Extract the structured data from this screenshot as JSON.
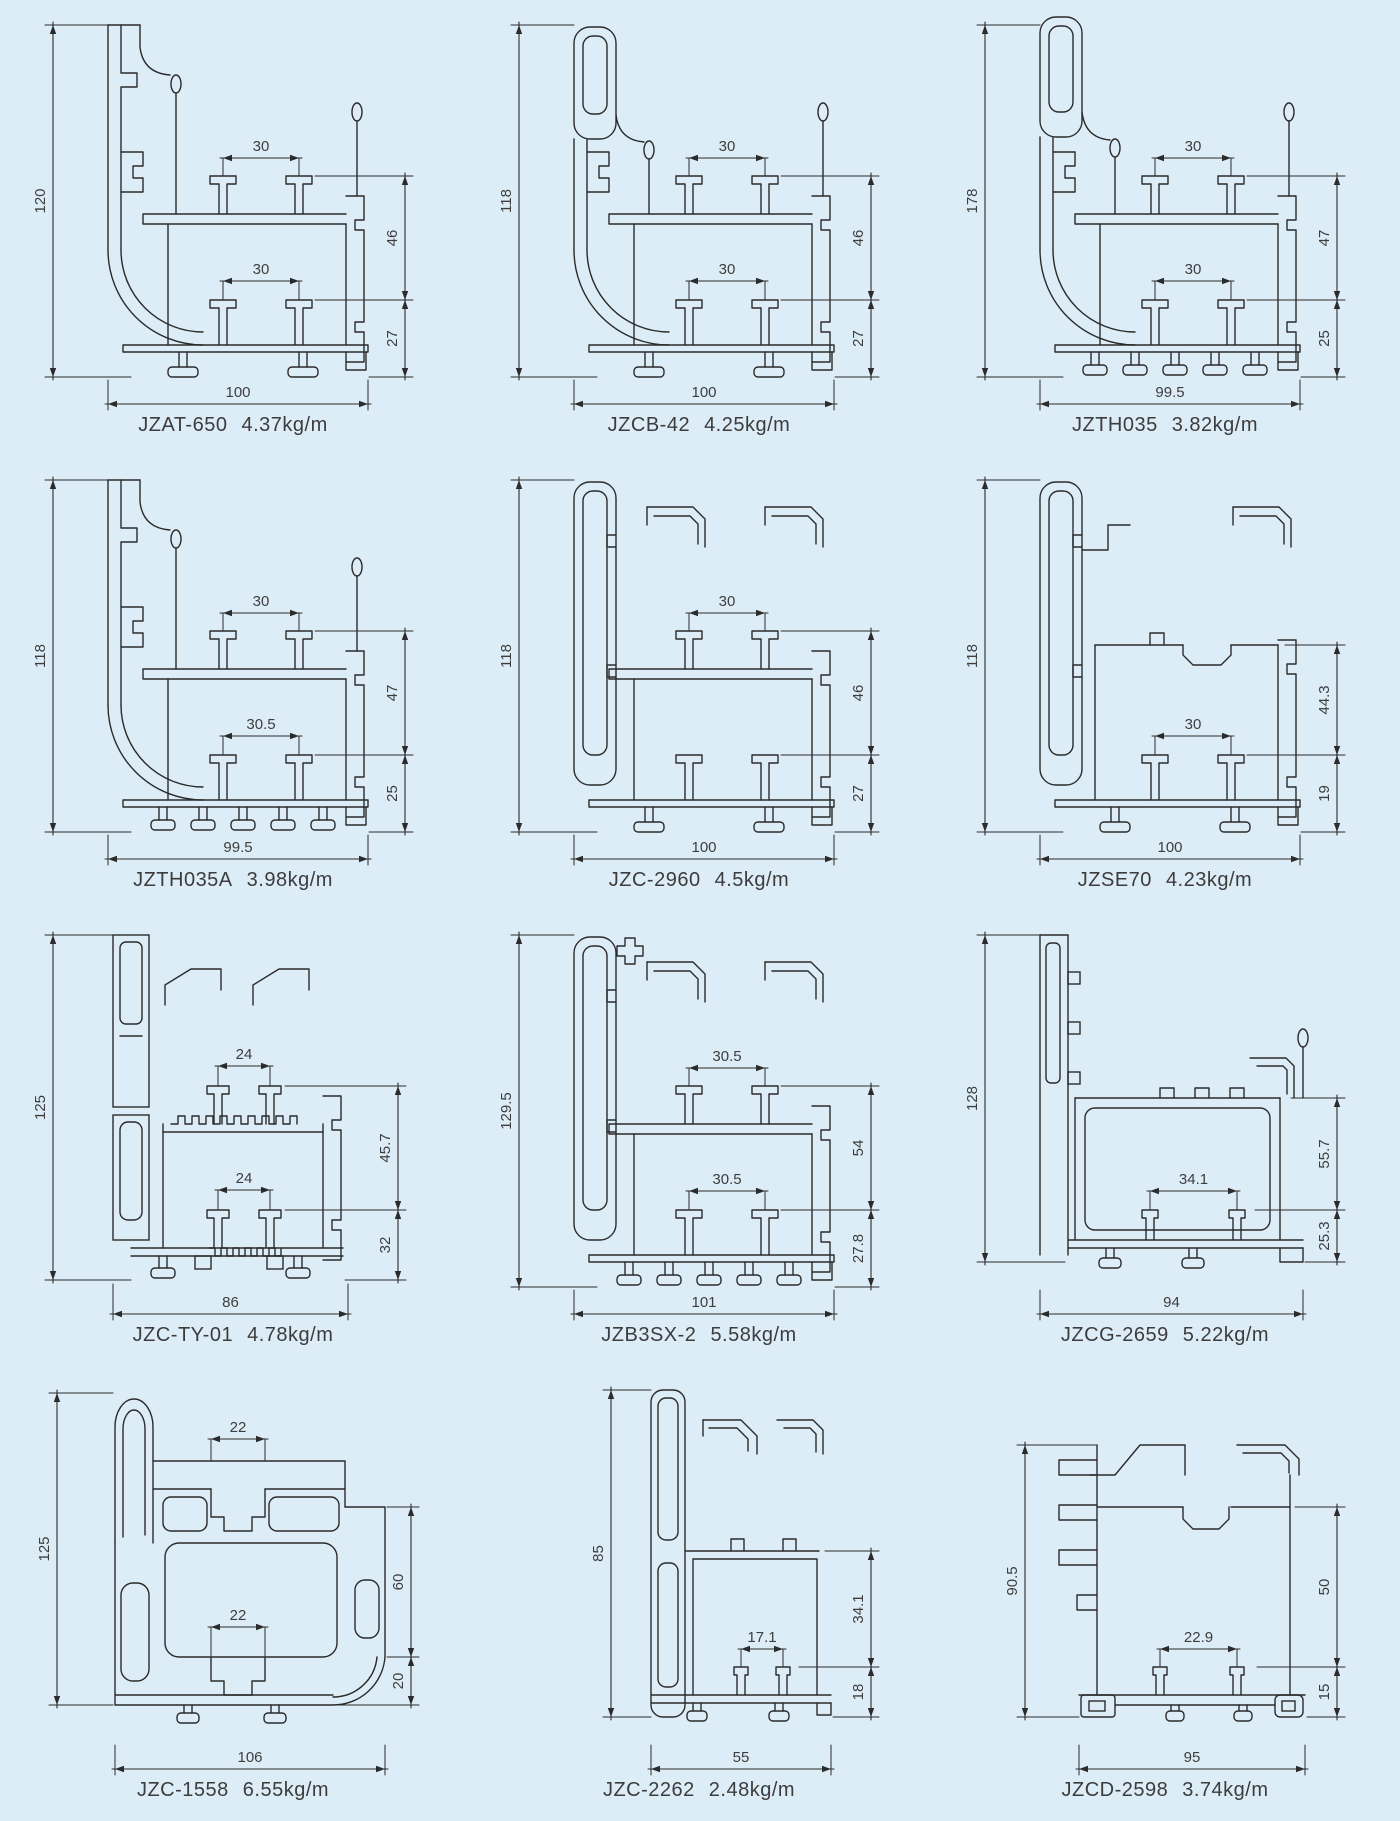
{
  "page": {
    "type": "aluminium-profile-catalog",
    "colors": {
      "background": "#ddedf8",
      "line": "#2b2b2b",
      "text": "#3d3d3d"
    }
  },
  "profiles": [
    {
      "name": "JZAT-650",
      "weight": "4.37kg/m",
      "dims": {
        "h": "120",
        "w": "100",
        "s1": "30",
        "s2": "30",
        "r1": "46",
        "r2": "27"
      }
    },
    {
      "name": "JZCB-42",
      "weight": "4.25kg/m",
      "dims": {
        "h": "118",
        "w": "100",
        "s1": "30",
        "s2": "30",
        "r1": "46",
        "r2": "27"
      }
    },
    {
      "name": "JZTH035",
      "weight": "3.82kg/m",
      "dims": {
        "h": "178",
        "w": "99.5",
        "s1": "30",
        "s2": "30",
        "r1": "47",
        "r2": "25"
      }
    },
    {
      "name": "JZTH035A",
      "weight": "3.98kg/m",
      "dims": {
        "h": "118",
        "w": "99.5",
        "s1": "30",
        "s2": "30.5",
        "r1": "47",
        "r2": "25"
      }
    },
    {
      "name": "JZC-2960",
      "weight": "4.5kg/m",
      "dims": {
        "h": "118",
        "w": "100",
        "s1": "30",
        "s2": "",
        "r1": "46",
        "r2": "27"
      }
    },
    {
      "name": "JZSE70",
      "weight": "4.23kg/m",
      "dims": {
        "h": "118",
        "w": "100",
        "s1": "",
        "s2": "30",
        "r1": "44.3",
        "r2": "19"
      }
    },
    {
      "name": "JZC-TY-01",
      "weight": "4.78kg/m",
      "dims": {
        "h": "125",
        "w": "86",
        "s1": "24",
        "s2": "24",
        "r1": "45.7",
        "r2": "32"
      }
    },
    {
      "name": "JZB3SX-2",
      "weight": "5.58kg/m",
      "dims": {
        "h": "129.5",
        "w": "101",
        "s1": "30.5",
        "s2": "30.5",
        "r1": "54",
        "r2": "27.8"
      }
    },
    {
      "name": "JZCG-2659",
      "weight": "5.22kg/m",
      "dims": {
        "h": "128",
        "w": "94",
        "s1": "",
        "s2": "34.1",
        "r1": "55.7",
        "r2": "25.3"
      }
    },
    {
      "name": "JZC-1558",
      "weight": "6.55kg/m",
      "dims": {
        "h": "125",
        "w": "106",
        "s1": "22",
        "s2": "22",
        "r1": "60",
        "r2": "20"
      }
    },
    {
      "name": "JZC-2262",
      "weight": "2.48kg/m",
      "dims": {
        "h": "85",
        "w": "55",
        "s1": "",
        "s2": "17.1",
        "r1": "34.1",
        "r2": "18"
      }
    },
    {
      "name": "JZCD-2598",
      "weight": "3.74kg/m",
      "dims": {
        "h": "90.5",
        "w": "95",
        "s1": "",
        "s2": "22.9",
        "r1": "50",
        "r2": "15"
      }
    }
  ]
}
